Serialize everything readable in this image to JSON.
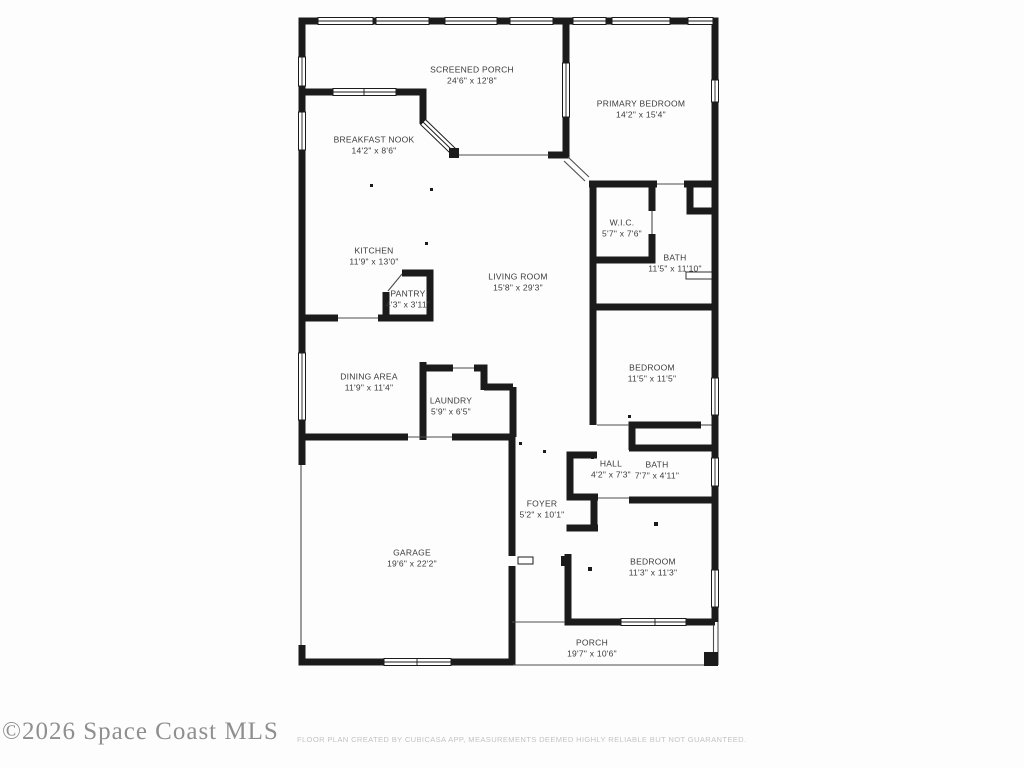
{
  "plan": {
    "wall_color": "#1b1b1b",
    "thin_line_color": "#4d4d4d",
    "label_color": "#3b3b3b"
  },
  "rooms": [
    {
      "id": "screened-porch",
      "name": "SCREENED PORCH",
      "dims": "24'6\" x 12'8\"",
      "x": 472,
      "y": 75
    },
    {
      "id": "primary-bedroom",
      "name": "PRIMARY BEDROOM",
      "dims": "14'2\" x 15'4\"",
      "x": 641,
      "y": 109
    },
    {
      "id": "breakfast-nook",
      "name": "BREAKFAST NOOK",
      "dims": "14'2\" x 8'6\"",
      "x": 374,
      "y": 145
    },
    {
      "id": "wic",
      "name": "W.I.C.",
      "dims": "5'7\" x 7'6\"",
      "x": 622,
      "y": 228
    },
    {
      "id": "kitchen",
      "name": "KITCHEN",
      "dims": "11'9\" x 13'0\"",
      "x": 374,
      "y": 256
    },
    {
      "id": "bath-primary",
      "name": "BATH",
      "dims": "11'5\" x 11'10\"",
      "x": 675,
      "y": 263
    },
    {
      "id": "living-room",
      "name": "LIVING ROOM",
      "dims": "15'8\" x 29'3\"",
      "x": 518,
      "y": 282
    },
    {
      "id": "pantry",
      "name": "PANTRY",
      "dims": "4'3\" x 3'11\"",
      "x": 408,
      "y": 299
    },
    {
      "id": "bedroom-middle",
      "name": "BEDROOM",
      "dims": "11'5\" x 11'5\"",
      "x": 652,
      "y": 373
    },
    {
      "id": "dining-area",
      "name": "DINING AREA",
      "dims": "11'9\" x 11'4\"",
      "x": 369,
      "y": 382
    },
    {
      "id": "laundry",
      "name": "LAUNDRY",
      "dims": "5'9\" x 6'5\"",
      "x": 451,
      "y": 406
    },
    {
      "id": "hall",
      "name": "HALL",
      "dims": "4'2\" x 7'3\"",
      "x": 611,
      "y": 469
    },
    {
      "id": "bath-hall",
      "name": "BATH",
      "dims": "7'7\" x 4'11\"",
      "x": 657,
      "y": 470
    },
    {
      "id": "foyer",
      "name": "FOYER",
      "dims": "5'2\" x 10'1\"",
      "x": 542,
      "y": 509
    },
    {
      "id": "garage",
      "name": "GARAGE",
      "dims": "19'6\" x 22'2\"",
      "x": 412,
      "y": 558
    },
    {
      "id": "bedroom-bottom",
      "name": "BEDROOM",
      "dims": "11'3\" x 11'3\"",
      "x": 653,
      "y": 567
    },
    {
      "id": "porch",
      "name": "PORCH",
      "dims": "19'7\" x 10'6\"",
      "x": 592,
      "y": 648
    }
  ],
  "footer": {
    "watermark": "©2026 Space Coast MLS",
    "disclaimer": "FLOOR PLAN CREATED BY CUBICASA APP, MEASUREMENTS DEEMED HIGHLY RELIABLE BUT NOT GUARANTEED."
  }
}
